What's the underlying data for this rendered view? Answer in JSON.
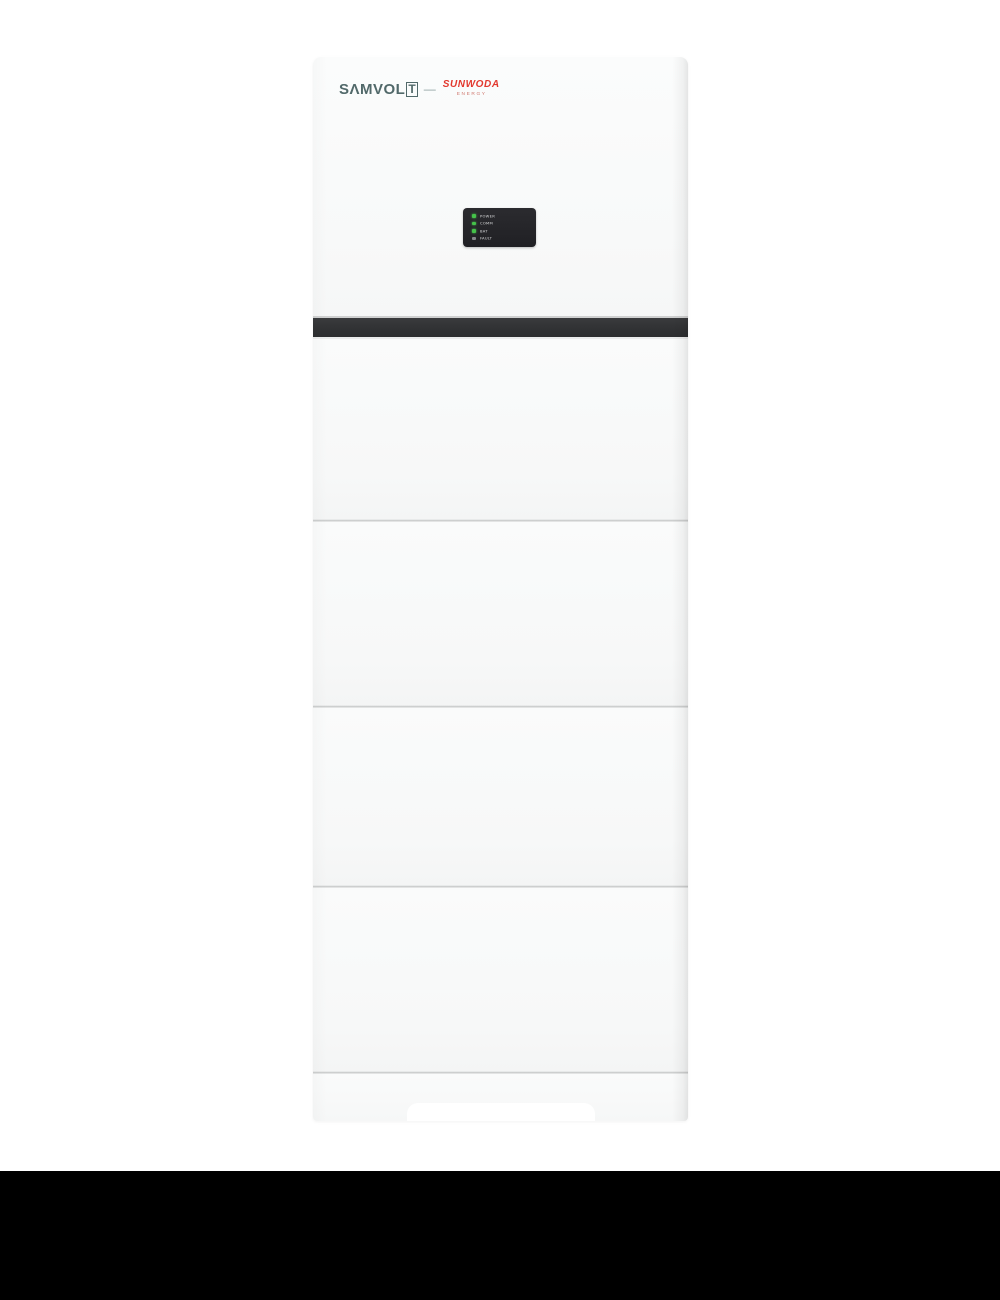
{
  "product": {
    "name": "stacked-energy-storage-tower",
    "brand": {
      "main_text": "SΛMVOL",
      "boxed_letter": "T",
      "separator": "—",
      "partner_text": "SUNWODA",
      "partner_subtext": "ENERGY"
    },
    "led_panel": {
      "indicators": [
        {
          "label": "POWER",
          "state": "on"
        },
        {
          "label": "COMM",
          "state": "on"
        },
        {
          "label": "BAT",
          "state": "on"
        },
        {
          "label": "FAULT",
          "state": "off"
        }
      ]
    },
    "module_count": 4,
    "colors": {
      "brand_teal": "#51696a",
      "partner_red": "#e2382e",
      "body_white": "#f8f9f9",
      "band_dark": "#313234",
      "panel_black": "#232327",
      "led_on_green": "#45c24a",
      "led_off_gray": "#85878a",
      "canvas_white": "#ffffff",
      "bottom_bar_black": "#000000"
    }
  }
}
